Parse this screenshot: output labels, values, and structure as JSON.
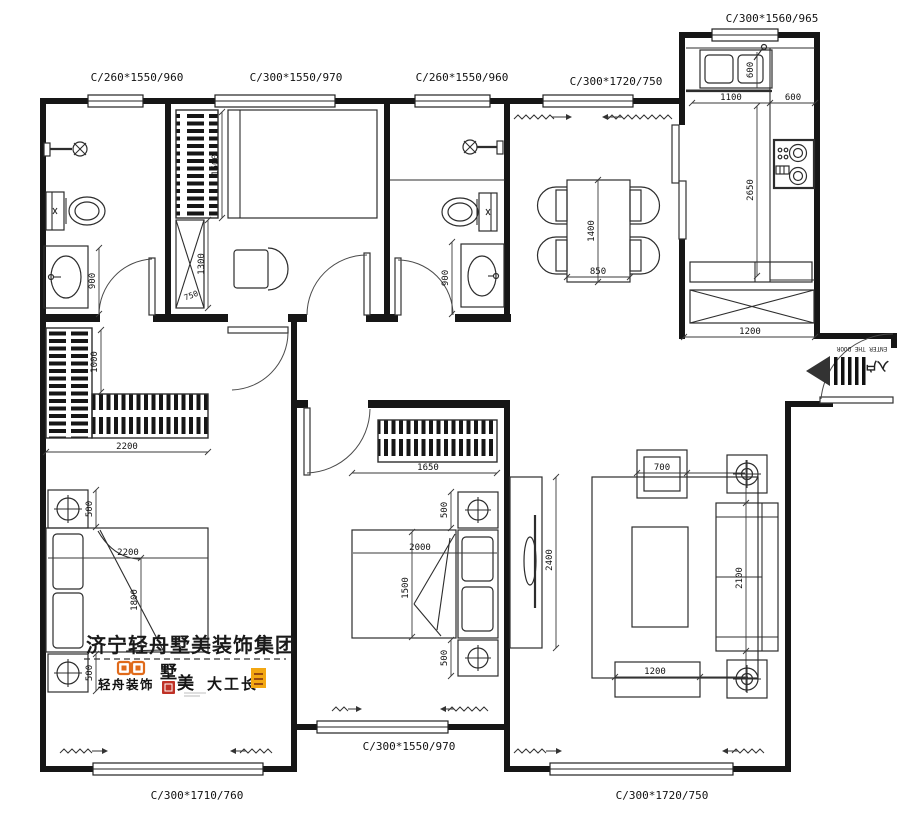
{
  "plan": {
    "watermark": "济宁轻舟墅美装饰集团",
    "logos": {
      "qingzhou": "轻舟装饰",
      "shu": "墅",
      "mei": "美",
      "dagongzhang": "大工长"
    },
    "entry": {
      "cn": "入户",
      "en": "ENTER THE DOOR"
    }
  },
  "windows": {
    "bath1_top": "C/260*1550/960",
    "bedroom2_top": "C/300*1550/970",
    "bath2_top": "C/260*1550/960",
    "dining_top": "C/300*1720/750",
    "kitchen_top": "C/300*1560/965",
    "master_bottom": "C/300*1710/760",
    "bedroom3_bottom": "C/300*1550/970",
    "living_bottom": "C/300*1720/750"
  },
  "dims": {
    "bath1_clearance": "900",
    "bed2_bed_width": "1500",
    "bed2_cabinet_h": "1300",
    "bed2_cabinet_w": "750",
    "bath2_clearance": "900",
    "dining_table_length": "1400",
    "dining_table_width": "850",
    "kitchen_sink": "600",
    "kitchen_counter_a": "1100",
    "kitchen_counter_b": "600",
    "kitchen_counter_len": "2650",
    "kitchen_cabinet": "1200",
    "master_wardrobe_depth": "1000",
    "master_wardrobe_width": "2200",
    "master_ns_top": "500",
    "master_bed_len": "2200",
    "master_bed_width": "1800",
    "master_ns_bottom": "500",
    "bed3_wardrobe": "1650",
    "bed3_ns_top": "500",
    "bed3_bed_len": "2000",
    "bed3_bed_width": "1500",
    "bed3_ns_bottom": "500",
    "living_tv_wall": "2400",
    "living_armchair": "700",
    "living_sofa": "2100",
    "living_table": "1200"
  },
  "colors": {
    "line": "#161616",
    "accent_orange": "#e06a1a",
    "seal_red": "#bf3126",
    "badge_yellow": "#f3a712"
  }
}
